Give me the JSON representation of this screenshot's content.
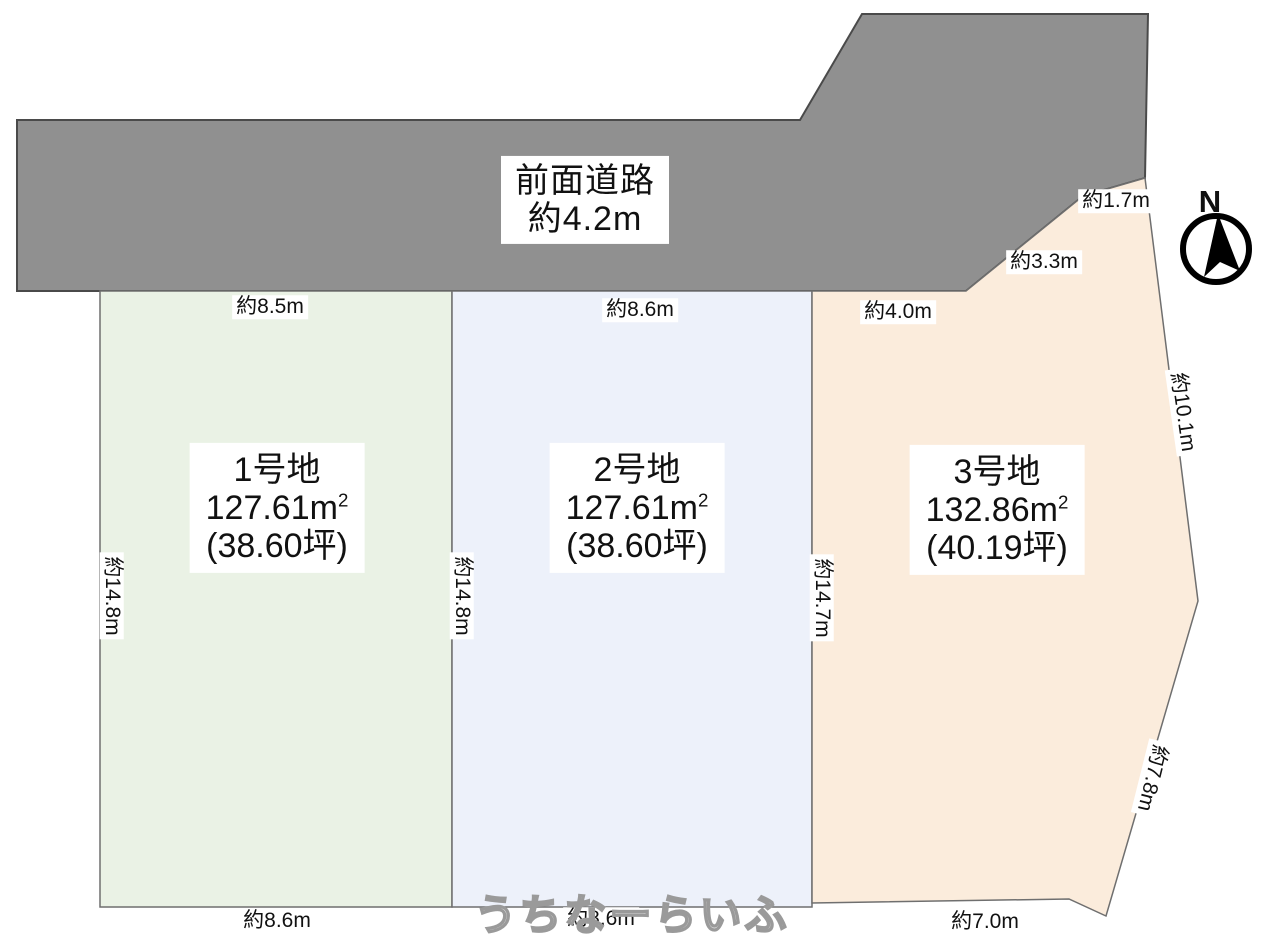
{
  "road": {
    "name_label": "前面道路",
    "width_label": "約4.2m"
  },
  "compass": {
    "north_label": "N"
  },
  "plots": [
    {
      "name": "1号地",
      "area_m2": "127.61m",
      "area_sup": "2",
      "area_tsubo": "(38.60坪)",
      "dim_top": "約8.5m",
      "dim_left": "約14.8m",
      "dim_bottom": "約8.6m"
    },
    {
      "name": "2号地",
      "area_m2": "127.61m",
      "area_sup": "2",
      "area_tsubo": "(38.60坪)",
      "dim_top": "約8.6m",
      "dim_left": "約14.8m",
      "dim_bottom": "約8.6m"
    },
    {
      "name": "3号地",
      "area_m2": "132.86m",
      "area_sup": "2",
      "area_tsubo": "(40.19坪)",
      "dim_top": "約4.0m",
      "dim_left": "約14.7m",
      "dim_bottom": "約7.0m",
      "dim_road_diag_upper": "約1.7m",
      "dim_road_diag_lower": "約3.3m",
      "dim_right_upper": "約10.1m",
      "dim_right_lower": "約7.8m"
    }
  ],
  "watermark": "うちなーらいふ",
  "colors": {
    "road_fill": "#909090",
    "road_stroke": "#4a4a4a",
    "plot1_fill": "#eaf2e5",
    "plot2_fill": "#edf1fa",
    "plot3_fill": "#fbecdc",
    "plot_stroke": "#6f6f6f",
    "compass": "#000000"
  }
}
